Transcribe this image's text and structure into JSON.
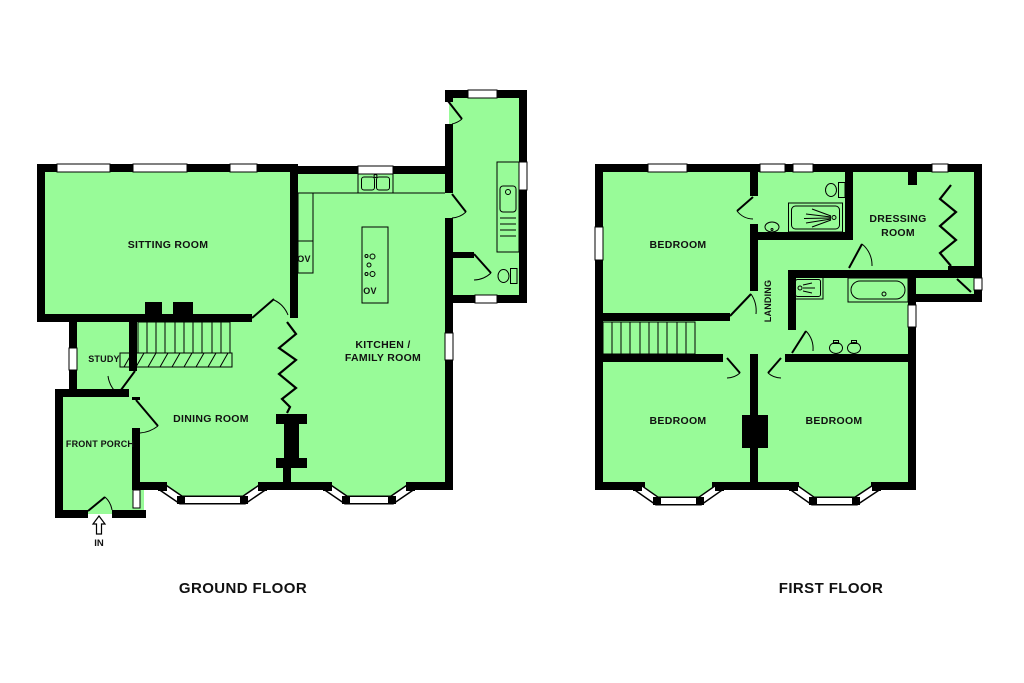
{
  "colors": {
    "room_fill": "#98fb98",
    "wall": "#000000",
    "background": "#ffffff",
    "text": "#111111"
  },
  "ground_floor": {
    "title": "GROUND FLOOR",
    "rooms": {
      "sitting_room": "SITTING ROOM",
      "study": "STUDY",
      "front_porch": "FRONT PORCH",
      "dining_room": "DINING ROOM",
      "kitchen_line1": "KITCHEN /",
      "kitchen_line2": "FAMILY ROOM",
      "oven_wall": "OV",
      "oven_island": "OV",
      "entrance": "IN"
    }
  },
  "first_floor": {
    "title": "FIRST FLOOR",
    "rooms": {
      "bedroom_top": "BEDROOM",
      "bedroom_bottom_left": "BEDROOM",
      "bedroom_bottom_right": "BEDROOM",
      "dressing_line1": "DRESSING",
      "dressing_line2": "ROOM",
      "landing": "LANDING"
    }
  }
}
